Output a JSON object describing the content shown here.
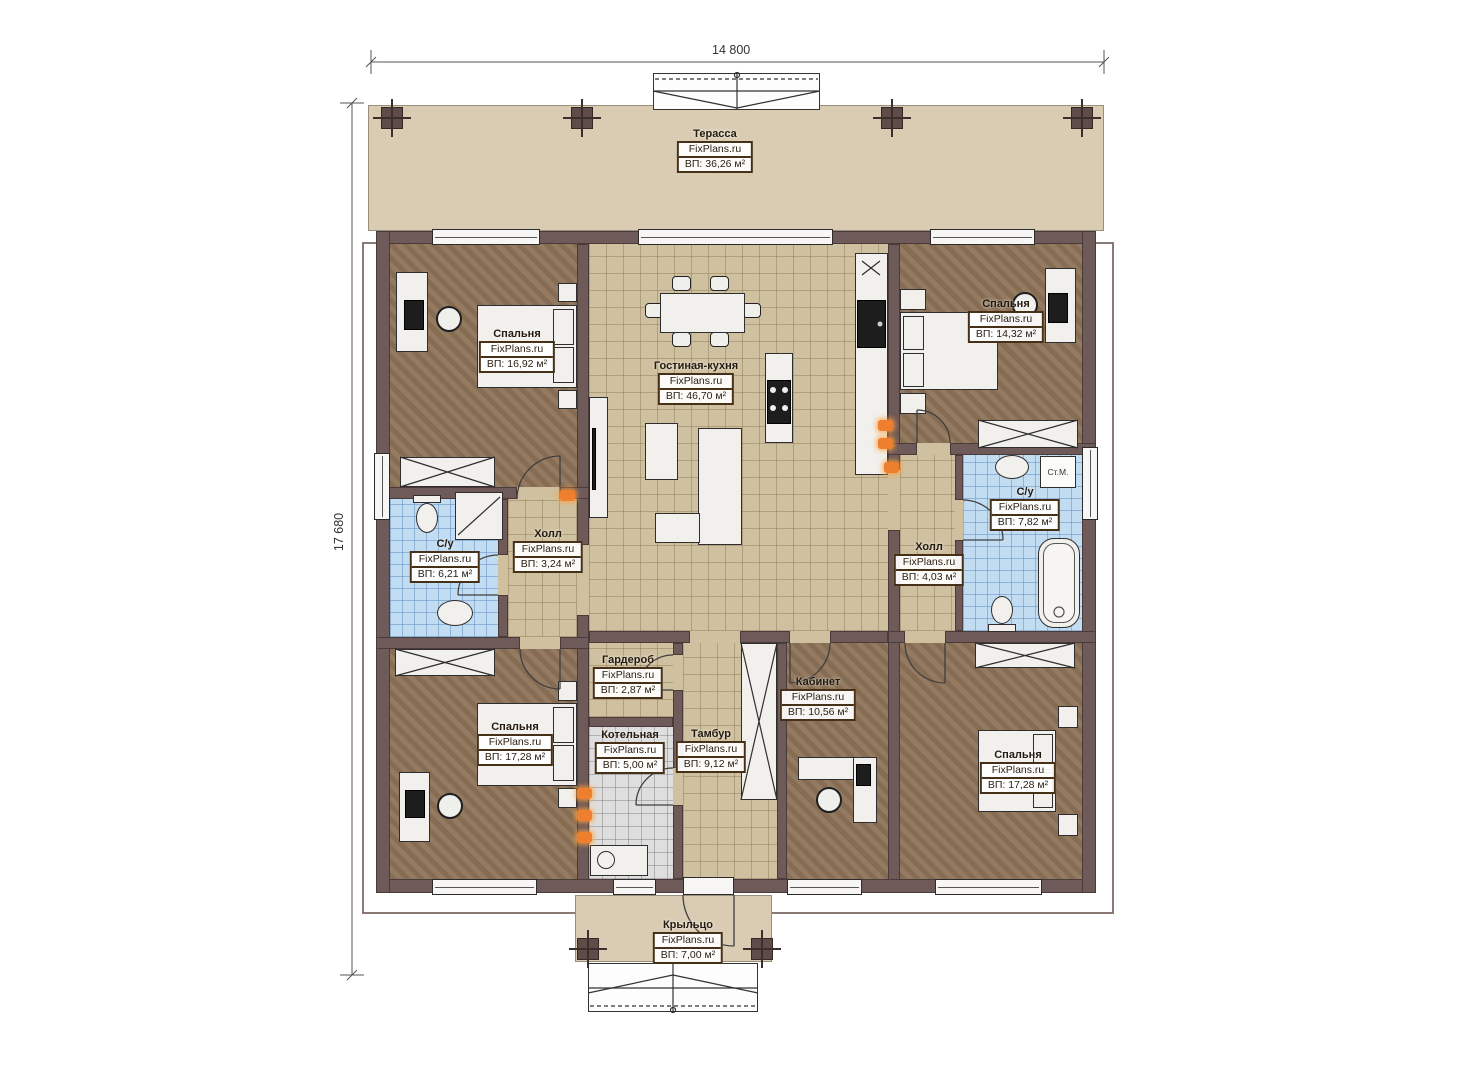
{
  "dimensions": {
    "width_label": "14 800",
    "height_label": "17 680"
  },
  "rooms": [
    {
      "id": "terrace",
      "name": "Терасса",
      "brand": "FixPlans.ru",
      "area": "ВП: 36,26 м²"
    },
    {
      "id": "bedroom-top-left",
      "name": "Спальня",
      "brand": "FixPlans.ru",
      "area": "ВП: 16,92 м²"
    },
    {
      "id": "living-kitchen",
      "name": "Гостиная-кухня",
      "brand": "FixPlans.ru",
      "area": "ВП: 46,70 м²"
    },
    {
      "id": "bedroom-top-right",
      "name": "Спальня",
      "brand": "FixPlans.ru",
      "area": "ВП: 14,32 м²"
    },
    {
      "id": "bathroom-left",
      "name": "С/у",
      "brand": "FixPlans.ru",
      "area": "ВП: 6,21 м²"
    },
    {
      "id": "hall-left",
      "name": "Холл",
      "brand": "FixPlans.ru",
      "area": "ВП: 3,24 м²"
    },
    {
      "id": "hall-right",
      "name": "Холл",
      "brand": "FixPlans.ru",
      "area": "ВП: 4,03 м²"
    },
    {
      "id": "bathroom-right",
      "name": "С/у",
      "brand": "FixPlans.ru",
      "area": "ВП: 7,82 м²"
    },
    {
      "id": "wardrobe-room",
      "name": "Гардероб",
      "brand": "FixPlans.ru",
      "area": "ВП: 2,87 м²"
    },
    {
      "id": "boiler-room",
      "name": "Котельная",
      "brand": "FixPlans.ru",
      "area": "ВП: 5,00 м²"
    },
    {
      "id": "vestibule",
      "name": "Тамбур",
      "brand": "FixPlans.ru",
      "area": "ВП: 9,12 м²"
    },
    {
      "id": "office",
      "name": "Кабинет",
      "brand": "FixPlans.ru",
      "area": "ВП: 10,56 м²"
    },
    {
      "id": "bedroom-bottom-left",
      "name": "Спальня",
      "brand": "FixPlans.ru",
      "area": "ВП: 17,28 м²"
    },
    {
      "id": "bedroom-bottom-right",
      "name": "Спальня",
      "brand": "FixPlans.ru",
      "area": "ВП: 17,28 м²"
    },
    {
      "id": "porch",
      "name": "Крыльцо",
      "brand": "FixPlans.ru",
      "area": "ВП: 7,00 м²"
    }
  ],
  "annotations": {
    "washing_machine": "Ст.М."
  },
  "colors": {
    "wall": "#6e5a59",
    "terrace": "#d9ccb3",
    "bedroom_floor": "#8d7357",
    "tile_floor": "#cfc09f",
    "bathroom_tile": "#c2dcf2",
    "boiler_tile": "#dedede",
    "outlet": "#ee7f2f"
  }
}
